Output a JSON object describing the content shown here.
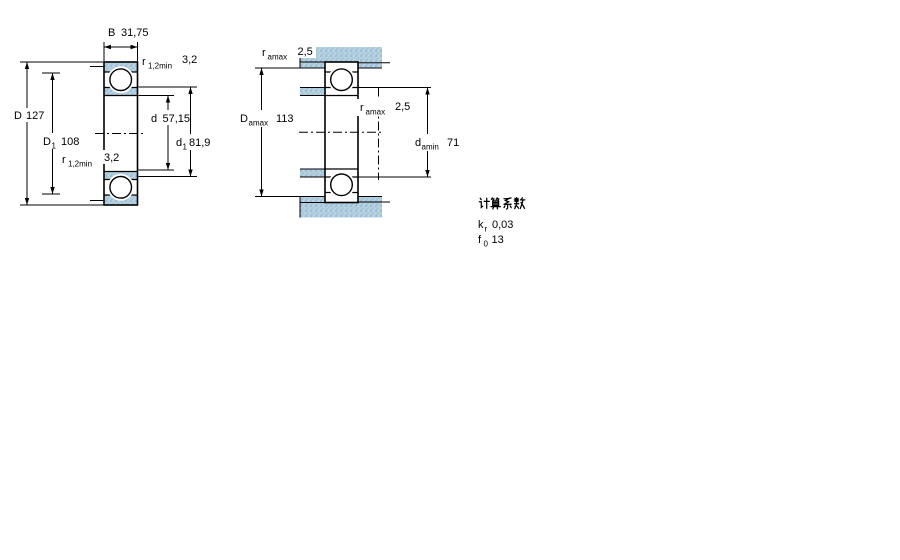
{
  "left_figure": {
    "dim_B": {
      "base": "B",
      "value": "31,75"
    },
    "dim_r_top": {
      "base": "r",
      "sub": "1,2min",
      "value": "3,2"
    },
    "dim_D": {
      "base": "D",
      "value": "127"
    },
    "dim_D1": {
      "base": "D",
      "sub": "1",
      "value": "108"
    },
    "dim_d": {
      "base": "d",
      "value": "57,15"
    },
    "dim_d1": {
      "base": "d",
      "sub": "1",
      "value": "81,9"
    },
    "dim_r_bottom": {
      "base": "r",
      "sub": "1,2min",
      "value": "3,2"
    }
  },
  "right_figure": {
    "dim_ra_top": {
      "base": "r",
      "sub": "amax",
      "value": "2,5"
    },
    "dim_Da": {
      "base": "D",
      "sub": "amax",
      "value": "113"
    },
    "dim_ra_mid": {
      "base": "r",
      "sub": "amax",
      "value": "2,5"
    },
    "dim_da": {
      "base": "d",
      "sub": "amin",
      "value": "71"
    }
  },
  "calculation_factors": {
    "heading": "计算系数",
    "rows": [
      {
        "base": "k",
        "sub": "r",
        "value": "0,03"
      },
      {
        "base": "f",
        "sub": "0",
        "value": "13"
      }
    ]
  },
  "colors": {
    "section_fill": "#b6d1e3",
    "section_dot": "#8ab1cb",
    "section_dot2": "#9fc7b8",
    "line_color": "#000000",
    "background": "#ffffff"
  }
}
